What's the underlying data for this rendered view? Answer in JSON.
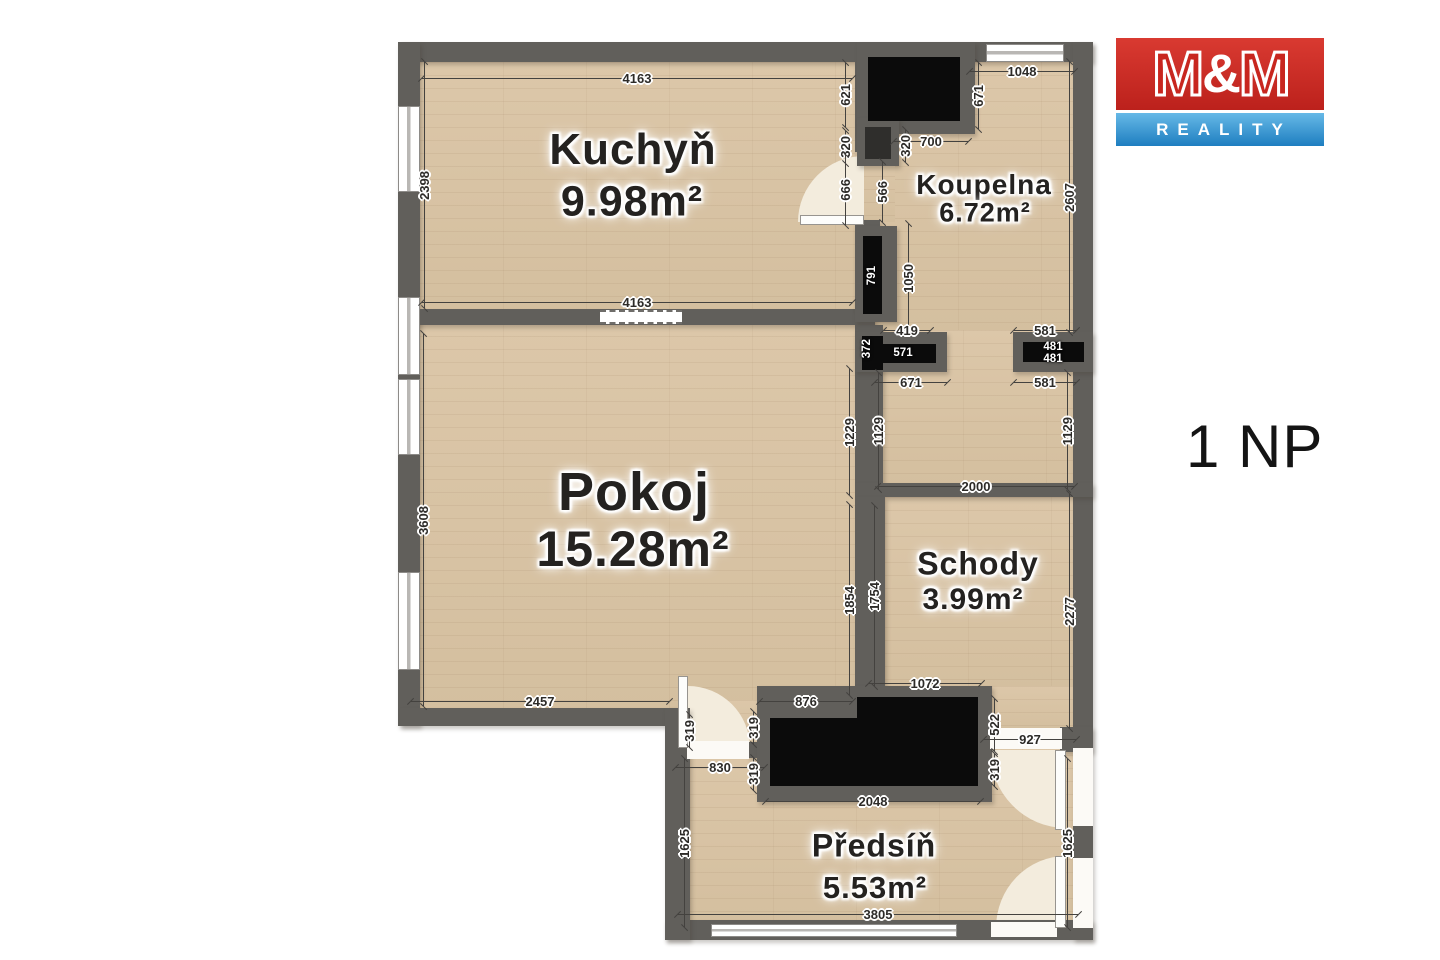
{
  "logo": {
    "m1": "M",
    "amp": "&",
    "m2": "M",
    "subtitle": "REALITY",
    "red": "#c8261f",
    "blue": "#2e8fd0"
  },
  "floor_label": "1 NP",
  "plan": {
    "room_labels": [
      {
        "t": "Kuchyň",
        "cx": 633,
        "cy": 150,
        "s": 44
      },
      {
        "t": "9.98m²",
        "cx": 632,
        "cy": 202,
        "s": 43
      },
      {
        "t": "Koupelna",
        "cx": 984,
        "cy": 185,
        "s": 28
      },
      {
        "t": "6.72m²",
        "cx": 985,
        "cy": 213,
        "s": 27
      },
      {
        "t": "Pokoj",
        "cx": 634,
        "cy": 492,
        "s": 54
      },
      {
        "t": "15.28m²",
        "cx": 633,
        "cy": 549,
        "s": 50
      },
      {
        "t": "Schody",
        "cx": 978,
        "cy": 564,
        "s": 32
      },
      {
        "t": "3.99m²",
        "cx": 973,
        "cy": 600,
        "s": 30
      },
      {
        "t": "Předsíň",
        "cx": 874,
        "cy": 846,
        "s": 32
      },
      {
        "t": "5.53m²",
        "cx": 875,
        "cy": 888,
        "s": 31
      }
    ],
    "dims": [
      {
        "t": "4163",
        "cx": 637,
        "cy": 78,
        "len": 430
      },
      {
        "t": "2398",
        "cx": 424,
        "cy": 185,
        "v": 1,
        "len": 246
      },
      {
        "t": "621",
        "cx": 845,
        "cy": 95,
        "v": 1,
        "len": 64
      },
      {
        "t": "320",
        "cx": 845,
        "cy": 147,
        "v": 1,
        "len": 32
      },
      {
        "t": "666",
        "cx": 845,
        "cy": 190,
        "v": 1,
        "len": 70
      },
      {
        "t": "4163",
        "cx": 637,
        "cy": 302,
        "len": 430
      },
      {
        "t": "671",
        "cx": 978,
        "cy": 96,
        "v": 1,
        "len": 66
      },
      {
        "t": "1048",
        "cx": 1022,
        "cy": 71,
        "len": 105
      },
      {
        "t": "700",
        "cx": 931,
        "cy": 141,
        "len": 74
      },
      {
        "t": "320",
        "cx": 905,
        "cy": 146,
        "v": 1,
        "len": 32
      },
      {
        "t": "566",
        "cx": 882,
        "cy": 192,
        "v": 1,
        "len": 60
      },
      {
        "t": "2607",
        "cx": 1069,
        "cy": 197,
        "v": 1,
        "len": 270
      },
      {
        "t": "1050",
        "cx": 908,
        "cy": 278,
        "v": 1,
        "len": 108
      },
      {
        "t": "791",
        "cx": 872,
        "cy": 276,
        "v": 1,
        "black": 1
      },
      {
        "t": "419",
        "cx": 907,
        "cy": 330,
        "len": 46
      },
      {
        "t": "581",
        "cx": 1045,
        "cy": 330,
        "len": 62
      },
      {
        "t": "372",
        "cx": 867,
        "cy": 349,
        "v": 1,
        "black": 1
      },
      {
        "t": "571",
        "cx": 903,
        "cy": 353,
        "black": 1
      },
      {
        "t": "481",
        "cx": 1053,
        "cy": 347,
        "black": 1
      },
      {
        "t": "481",
        "cx": 1053,
        "cy": 359,
        "black": 1
      },
      {
        "t": "671",
        "cx": 911,
        "cy": 382,
        "len": 72
      },
      {
        "t": "581",
        "cx": 1045,
        "cy": 382,
        "len": 62
      },
      {
        "t": "1229",
        "cx": 849,
        "cy": 432,
        "v": 1,
        "len": 126
      },
      {
        "t": "1129",
        "cx": 878,
        "cy": 431,
        "v": 1,
        "len": 116
      },
      {
        "t": "1129",
        "cx": 1067,
        "cy": 431,
        "v": 1,
        "len": 116
      },
      {
        "t": "2000",
        "cx": 976,
        "cy": 486,
        "len": 196
      },
      {
        "t": "3608",
        "cx": 423,
        "cy": 520,
        "v": 1,
        "len": 372
      },
      {
        "t": "1854",
        "cx": 849,
        "cy": 600,
        "v": 1,
        "len": 190
      },
      {
        "t": "1754",
        "cx": 874,
        "cy": 596,
        "v": 1,
        "len": 180
      },
      {
        "t": "2277",
        "cx": 1069,
        "cy": 611,
        "v": 1,
        "len": 234
      },
      {
        "t": "2457",
        "cx": 540,
        "cy": 701,
        "len": 258
      },
      {
        "t": "876",
        "cx": 806,
        "cy": 701,
        "len": 93
      },
      {
        "t": "1072",
        "cx": 925,
        "cy": 683,
        "len": 112
      },
      {
        "t": "522",
        "cx": 994,
        "cy": 725,
        "v": 1,
        "len": 52
      },
      {
        "t": "927",
        "cx": 1030,
        "cy": 739,
        "len": 92
      },
      {
        "t": "319",
        "cx": 994,
        "cy": 770,
        "v": 1,
        "len": 33
      },
      {
        "t": "319",
        "cx": 689,
        "cy": 731,
        "v": 1,
        "len": 33
      },
      {
        "t": "319",
        "cx": 753,
        "cy": 728,
        "v": 1,
        "len": 33
      },
      {
        "t": "830",
        "cx": 720,
        "cy": 767,
        "len": 88
      },
      {
        "t": "319",
        "cx": 753,
        "cy": 774,
        "v": 1,
        "len": 33
      },
      {
        "t": "2048",
        "cx": 873,
        "cy": 801,
        "len": 215
      },
      {
        "t": "1625",
        "cx": 684,
        "cy": 843,
        "v": 1,
        "len": 168
      },
      {
        "t": "1625",
        "cx": 1067,
        "cy": 843,
        "v": 1,
        "len": 168
      },
      {
        "t": "3805",
        "cx": 878,
        "cy": 914,
        "len": 400
      }
    ]
  }
}
